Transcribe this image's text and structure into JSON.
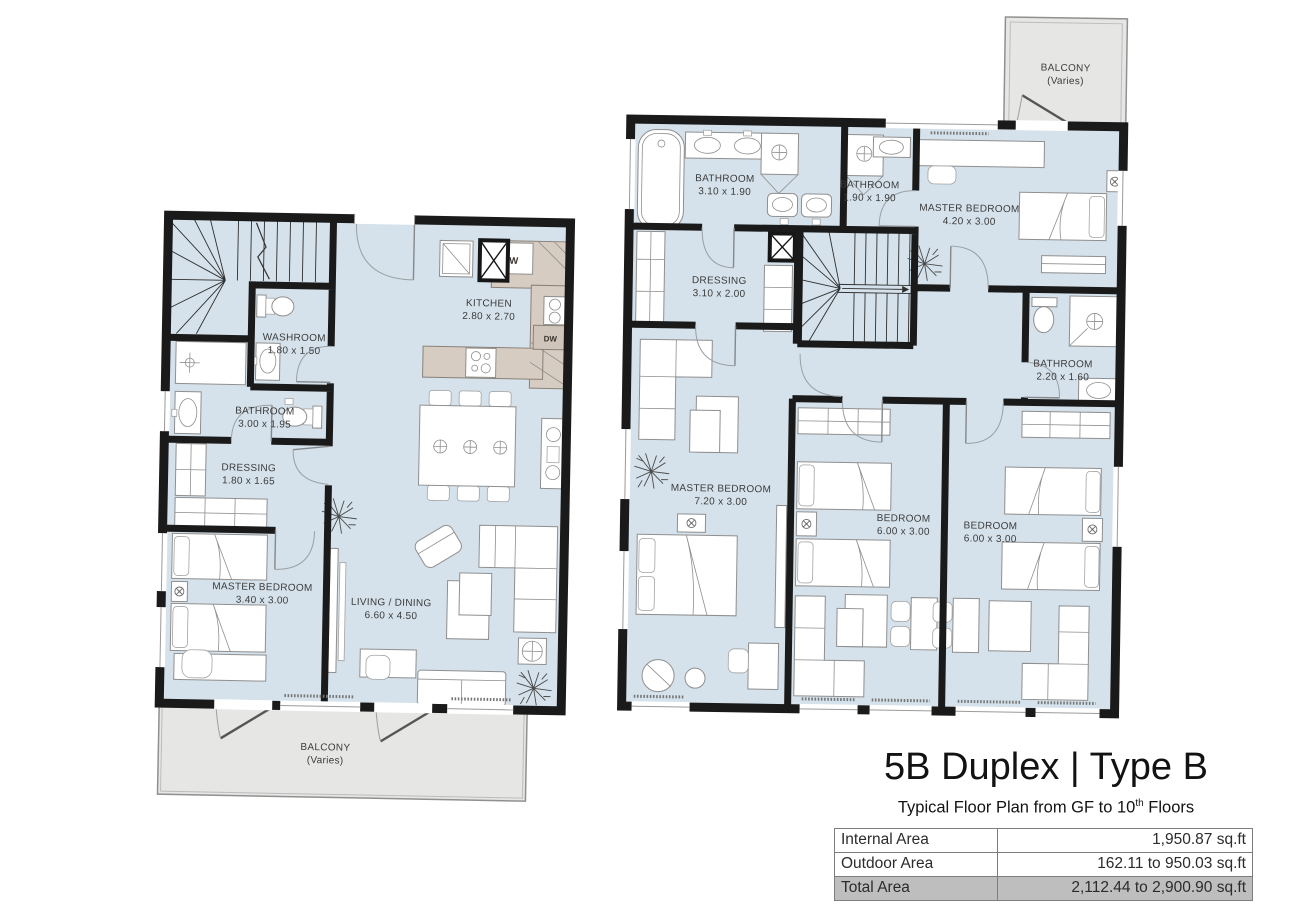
{
  "title_block": {
    "title": "5B Duplex | Type B",
    "subtitle_prefix": "Typical Floor Plan from GF to 10",
    "subtitle_sup": "th",
    "subtitle_suffix": " Floors",
    "table": {
      "rows": [
        {
          "label": "Internal Area",
          "value": "1,950.87 sq.ft",
          "highlight": false
        },
        {
          "label": "Outdoor Area",
          "value": "162.11 to 950.03 sq.ft",
          "highlight": false
        },
        {
          "label": "Total Area",
          "value": "2,112.44 to 2,900.90 sq.ft",
          "highlight": true
        }
      ]
    }
  },
  "colors": {
    "floor": "#d5e2eb",
    "balcony": "#e6e6e4",
    "wall": "#1a1a1a",
    "counter": "#d6ccc1",
    "furniture_stroke": "#8f8f8f",
    "label_text": "#3b3b3b",
    "total_row_bg": "#bfbebe"
  },
  "lower_floor": {
    "rooms": [
      {
        "id": "washroom",
        "label": "WASHROOM",
        "dims": "1.80 x 1.50"
      },
      {
        "id": "bathroom",
        "label": "BATHROOM",
        "dims": "3.00 x 1.95"
      },
      {
        "id": "dressing",
        "label": "DRESSING",
        "dims": "1.80 x 1.65"
      },
      {
        "id": "master-bedroom",
        "label": "MASTER BEDROOM",
        "dims": "3.40 x 3.00"
      },
      {
        "id": "kitchen",
        "label": "KITCHEN",
        "dims": "2.80 x 2.70"
      },
      {
        "id": "living-dining",
        "label": "LIVING / DINING",
        "dims": "6.60 x 4.50"
      },
      {
        "id": "balcony",
        "label": "BALCONY",
        "dims": "(Varies)"
      }
    ],
    "appliances": {
      "washer": "W",
      "dishwasher": "DW"
    }
  },
  "upper_floor": {
    "rooms": [
      {
        "id": "bathroom-1",
        "label": "BATHROOM",
        "dims": "3.10 x 1.90"
      },
      {
        "id": "bathroom-2",
        "label": "BATHROOM",
        "dims": "1.90 x 1.90"
      },
      {
        "id": "master-bedroom-1",
        "label": "MASTER BEDROOM",
        "dims": "4.20 x 3.00"
      },
      {
        "id": "dressing",
        "label": "DRESSING",
        "dims": "3.10 x 2.00"
      },
      {
        "id": "bathroom-3",
        "label": "BATHROOM",
        "dims": "2.20 x 1.60"
      },
      {
        "id": "master-bedroom-2",
        "label": "MASTER BEDROOM",
        "dims": "7.20 x 3.00"
      },
      {
        "id": "bedroom-1",
        "label": "BEDROOM",
        "dims": "6.00 x 3.00"
      },
      {
        "id": "bedroom-2",
        "label": "BEDROOM",
        "dims": "6.00 x 3.00"
      },
      {
        "id": "balcony",
        "label": "BALCONY",
        "dims": "(Varies)"
      }
    ]
  }
}
